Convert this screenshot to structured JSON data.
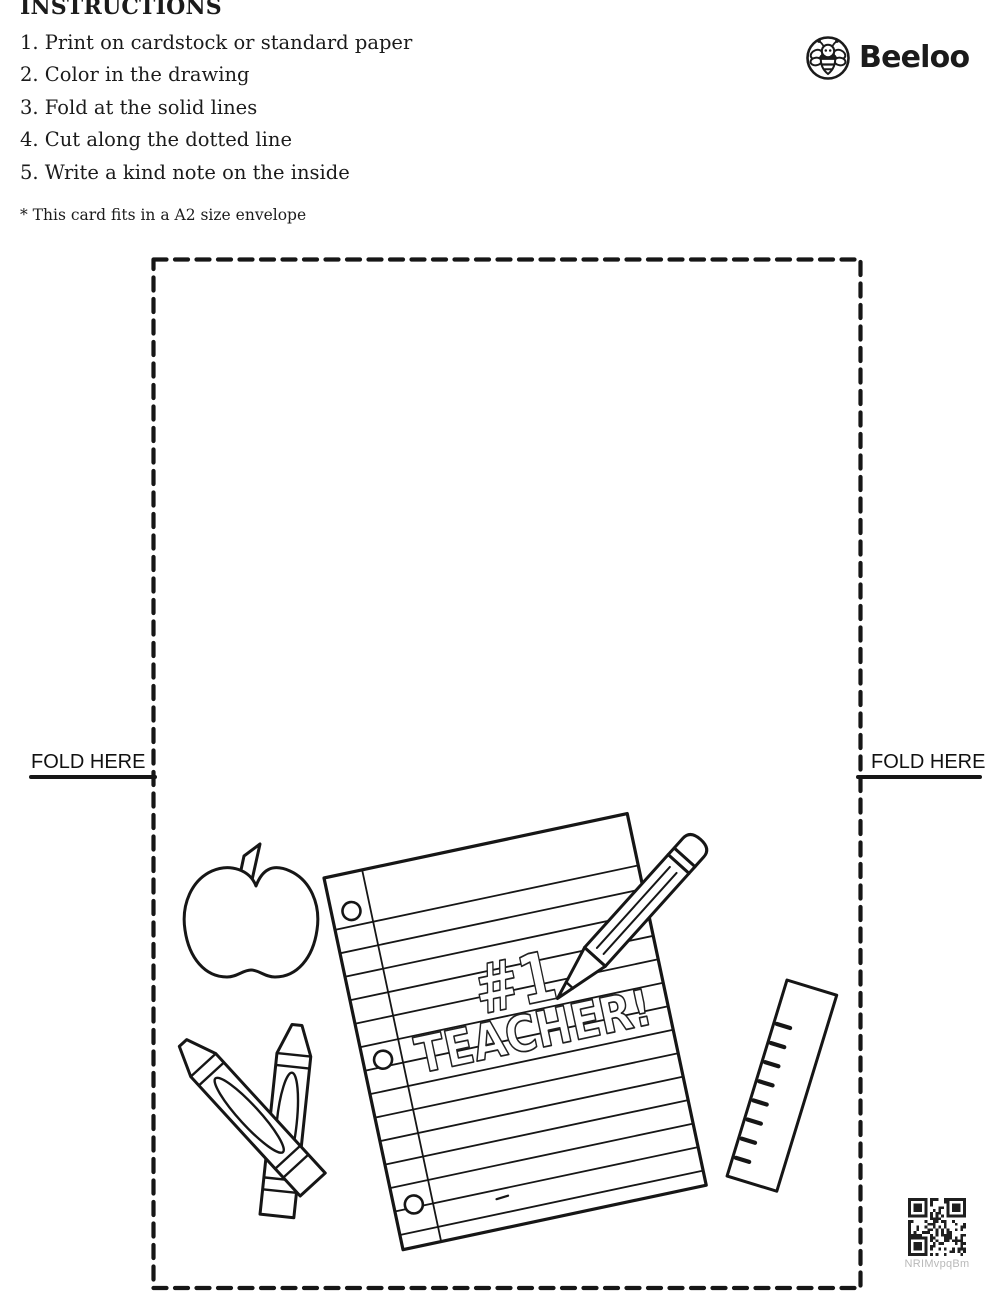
{
  "instructions": {
    "title": "INSTRUCTIONS",
    "steps": [
      "1. Print on cardstock or standard paper",
      "2. Color in the drawing",
      "3. Fold at the solid lines",
      "4. Cut along the dotted line",
      "5. Write a kind note on the inside"
    ],
    "note": "* This card fits in a A2 size envelope"
  },
  "brand": {
    "name": "Beeloo",
    "icon": "bee-icon"
  },
  "card": {
    "fold_left": "FOLD HERE",
    "fold_right": "FOLD HERE",
    "artwork": {
      "caption_line1": "#1",
      "caption_line2": "TEACHER!",
      "objects": [
        "apple",
        "crayons",
        "lined-paper",
        "pencil",
        "ruler"
      ]
    }
  },
  "qr": {
    "label": "NRIMvpqBm"
  },
  "colors": {
    "ink": "#1b1b1b",
    "qr_label": "#b9b9b9"
  }
}
